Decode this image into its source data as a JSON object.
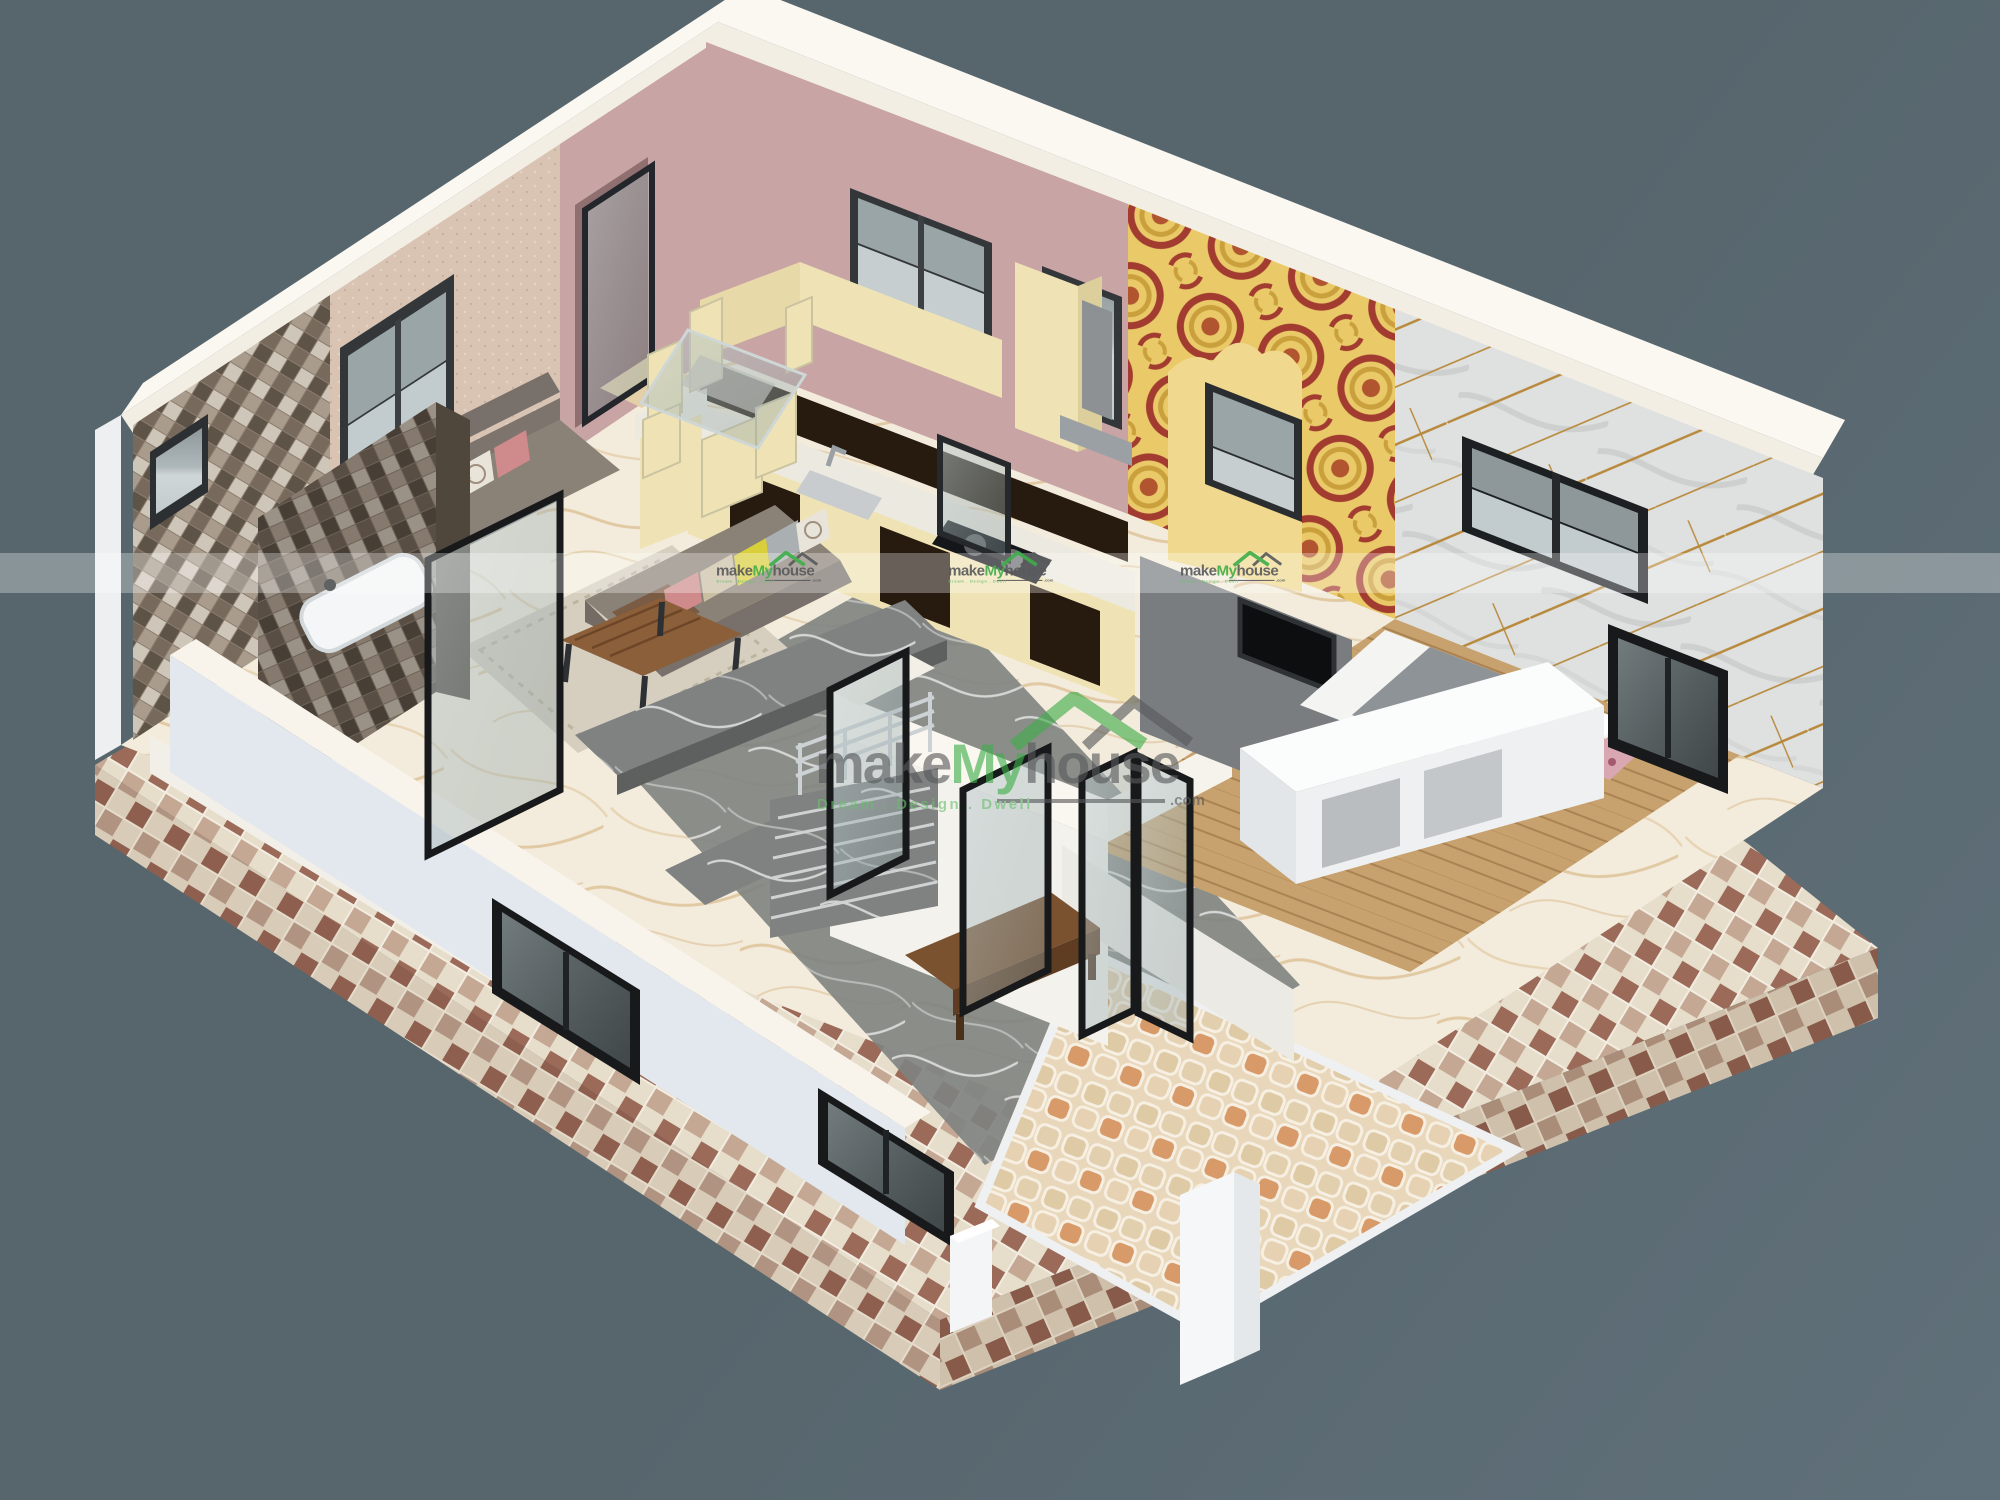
{
  "watermark": {
    "word1": "make",
    "word2": "My",
    "word3": "house",
    "tld": ".com",
    "tagline": "Dream . Design . Dwell"
  },
  "watermark_band": {
    "band_y": 553,
    "band_height": 40,
    "small_logo_centers_x": [
      768,
      1000,
      1232
    ]
  },
  "palette": {
    "bg": "#57666d",
    "bg2": "#60707a",
    "brand-green": "#3fae49",
    "brand-gray": "#58595b",
    "tagline-green": "#6abf6d",
    "wall-pink": "#c9a4a4",
    "wall-pink-dark": "#8f6f70",
    "wall-beige": "#d9c3b2",
    "wall-yellow": "#e9c968",
    "gold-line": "#b8893c",
    "cream": "#efe3b5",
    "cabinet-dark": "#271b10",
    "sofa": "#8a8177",
    "wood": "#8a5f3a",
    "floor-marble": "#f3ecdc",
    "floor-wood": "#c8a26e",
    "checker-brown": "#9b6a58",
    "checker-cream": "#e7ddcb",
    "white-wall": "#f4f2ed"
  }
}
